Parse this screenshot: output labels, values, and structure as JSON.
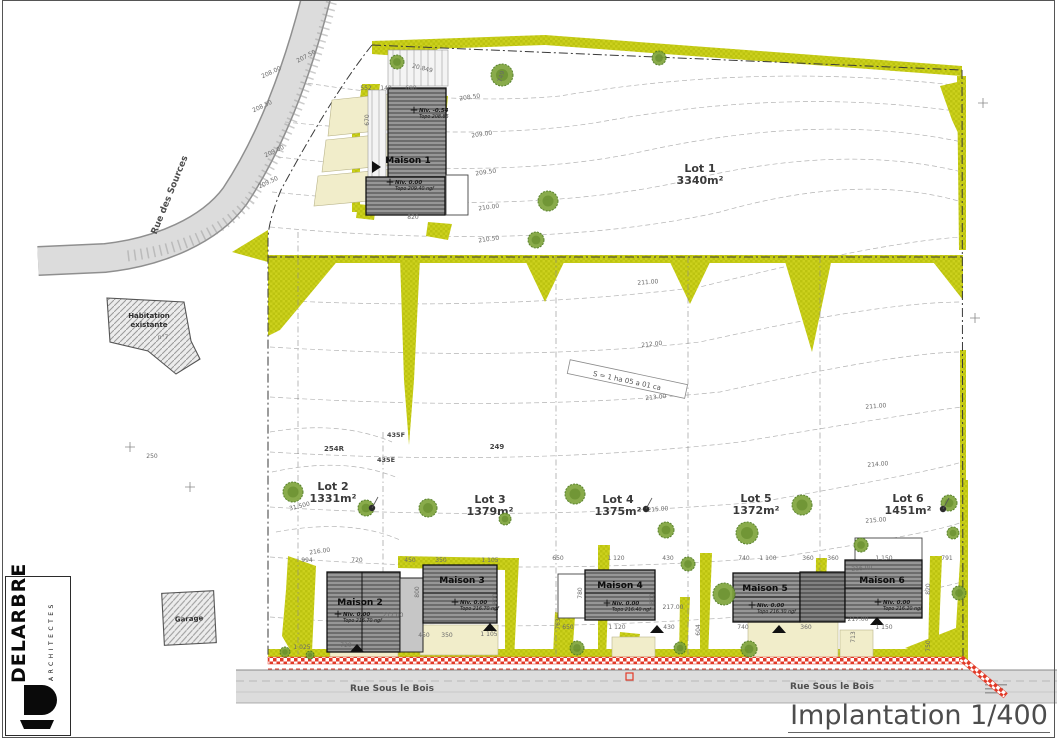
{
  "sheet": {
    "title": "Implantation 1/400"
  },
  "firm": {
    "name": "DELARBRE",
    "subtitle": "ARCHITECTES"
  },
  "streets": {
    "sources": "Rue des Sources",
    "sous_le_bois_1": "Rue Sous le Bois",
    "sous_le_bois_2": "Rue Sous le Bois"
  },
  "site": {
    "total_area": "S = 1 ha 05 a 01 ca"
  },
  "existing": {
    "habitation_1": "Habitation",
    "habitation_2": "existante",
    "habitation_no": "n°7",
    "garage": "Garage"
  },
  "lots": [
    {
      "name": "Lot 1",
      "area": "3340m²"
    },
    {
      "name": "Lot 2",
      "area": "1331m²"
    },
    {
      "name": "Lot 3",
      "area": "1379m²"
    },
    {
      "name": "Lot 4",
      "area": "1375m²"
    },
    {
      "name": "Lot 5",
      "area": "1372m²"
    },
    {
      "name": "Lot 6",
      "area": "1451m²"
    }
  ],
  "houses": [
    {
      "name": "Maison 1",
      "niv": "Niv. 0.00",
      "topo": "Topo 209.40 ngf"
    },
    {
      "name": "Maison 2",
      "niv": "Niv. 0.00",
      "topo": "Topo 216.70 ngf"
    },
    {
      "name": "Maison 3",
      "niv": "Niv. 0.00",
      "topo": "Topo 216.70 ngf"
    },
    {
      "name": "Maison 4",
      "niv": "Niv. 0.00",
      "topo": "Topo 216.40 ngf"
    },
    {
      "name": "Maison 5",
      "niv": "Niv. 0.00",
      "topo": "Topo 216.30 ngf"
    },
    {
      "name": "Maison 6",
      "niv": "Niv. 0.00",
      "topo": "Topo 216.20 ngf"
    }
  ],
  "house1_upper": {
    "niv": "Niv. -0.54",
    "topo": "Topo 208.86"
  },
  "plan": {
    "labels": [
      {
        "t": "207.50",
        "x": 307,
        "y": 58,
        "r": -28
      },
      {
        "t": "208.00",
        "x": 272,
        "y": 74,
        "r": -25
      },
      {
        "t": "208.50",
        "x": 263,
        "y": 108,
        "r": -25
      },
      {
        "t": "209.00",
        "x": 275,
        "y": 153,
        "r": -25
      },
      {
        "t": "209.50",
        "x": 269,
        "y": 184,
        "r": -25
      },
      {
        "t": "208.50",
        "x": 470,
        "y": 99,
        "r": -8
      },
      {
        "t": "209.00",
        "x": 482,
        "y": 136,
        "r": -8
      },
      {
        "t": "209.50",
        "x": 486,
        "y": 174,
        "r": -8
      },
      {
        "t": "210.00",
        "x": 489,
        "y": 209,
        "r": -8
      },
      {
        "t": "210.50",
        "x": 489,
        "y": 241,
        "r": -8
      },
      {
        "t": "211.00",
        "x": 648,
        "y": 284,
        "r": -4
      },
      {
        "t": "212.00",
        "x": 652,
        "y": 346,
        "r": -6
      },
      {
        "t": "213.00",
        "x": 656,
        "y": 399,
        "r": -6
      },
      {
        "t": "211.00",
        "x": 876,
        "y": 408,
        "r": -4
      },
      {
        "t": "214.00",
        "x": 878,
        "y": 466,
        "r": -4
      },
      {
        "t": "215.00",
        "x": 658,
        "y": 511,
        "r": -4
      },
      {
        "t": "215.00",
        "x": 876,
        "y": 522,
        "r": -4
      },
      {
        "t": "216.00",
        "x": 320,
        "y": 553,
        "r": -8
      },
      {
        "t": "216.00",
        "x": 862,
        "y": 570,
        "r": -4
      },
      {
        "t": "217.00",
        "x": 393,
        "y": 617
      },
      {
        "t": "217.00",
        "x": 673,
        "y": 609
      },
      {
        "t": "217.00",
        "x": 858,
        "y": 621
      },
      {
        "t": "31.500",
        "x": 300,
        "y": 508,
        "r": -14
      },
      {
        "t": "20.849",
        "x": 422,
        "y": 70,
        "r": 14
      },
      {
        "t": "254R",
        "x": 334,
        "y": 451,
        "s": 7,
        "b": 1,
        "c": "#444"
      },
      {
        "t": "435F",
        "x": 396,
        "y": 437,
        "s": 6.5,
        "b": 1,
        "c": "#444"
      },
      {
        "t": "435E",
        "x": 386,
        "y": 462,
        "s": 6.5,
        "b": 1,
        "c": "#444"
      },
      {
        "t": "249",
        "x": 497,
        "y": 449,
        "s": 7,
        "b": 1,
        "c": "#444"
      },
      {
        "t": "250",
        "x": 152,
        "y": 458
      },
      {
        "t": "994",
        "x": 307,
        "y": 562
      },
      {
        "t": "720",
        "x": 357,
        "y": 562
      },
      {
        "t": "450",
        "x": 410,
        "y": 562
      },
      {
        "t": "350",
        "x": 441,
        "y": 562
      },
      {
        "t": "1 105",
        "x": 490,
        "y": 562
      },
      {
        "t": "650",
        "x": 558,
        "y": 560
      },
      {
        "t": "1 120",
        "x": 616,
        "y": 560
      },
      {
        "t": "430",
        "x": 668,
        "y": 560
      },
      {
        "t": "740",
        "x": 744,
        "y": 560
      },
      {
        "t": "1 100",
        "x": 768,
        "y": 560
      },
      {
        "t": "360",
        "x": 808,
        "y": 560
      },
      {
        "t": "360",
        "x": 833,
        "y": 560
      },
      {
        "t": "1 150",
        "x": 884,
        "y": 560
      },
      {
        "t": "791",
        "x": 947,
        "y": 560
      },
      {
        "t": "1 025",
        "x": 302,
        "y": 649
      },
      {
        "t": "720",
        "x": 346,
        "y": 647
      },
      {
        "t": "450",
        "x": 424,
        "y": 637
      },
      {
        "t": "350",
        "x": 447,
        "y": 637
      },
      {
        "t": "1 105",
        "x": 489,
        "y": 636
      },
      {
        "t": "650",
        "x": 568,
        "y": 629
      },
      {
        "t": "1 120",
        "x": 617,
        "y": 629
      },
      {
        "t": "430",
        "x": 669,
        "y": 629
      },
      {
        "t": "740",
        "x": 743,
        "y": 629
      },
      {
        "t": "360",
        "x": 806,
        "y": 629
      },
      {
        "t": "1 150",
        "x": 884,
        "y": 629
      },
      {
        "t": "713",
        "x": 855,
        "y": 637,
        "r": -90
      },
      {
        "t": "763",
        "x": 560,
        "y": 624,
        "r": -90
      },
      {
        "t": "604",
        "x": 700,
        "y": 630,
        "r": -90
      },
      {
        "t": "670",
        "x": 369,
        "y": 120,
        "r": -90
      },
      {
        "t": "800",
        "x": 419,
        "y": 592,
        "r": -90
      },
      {
        "t": "800",
        "x": 497,
        "y": 599,
        "r": -90
      },
      {
        "t": "780",
        "x": 582,
        "y": 593,
        "r": -90
      },
      {
        "t": "800",
        "x": 654,
        "y": 599,
        "r": -90
      },
      {
        "t": "820",
        "x": 930,
        "y": 589,
        "r": -90
      },
      {
        "t": "750",
        "x": 930,
        "y": 646,
        "r": -90
      },
      {
        "t": "552",
        "x": 366,
        "y": 90
      },
      {
        "t": "140",
        "x": 386,
        "y": 90
      },
      {
        "t": "690",
        "x": 411,
        "y": 90
      },
      {
        "t": "749",
        "x": 503,
        "y": 77,
        "r": -75
      },
      {
        "t": "820",
        "x": 413,
        "y": 219
      }
    ],
    "trees": [
      [
        397,
        62,
        7
      ],
      [
        502,
        75,
        11
      ],
      [
        659,
        58,
        7
      ],
      [
        548,
        201,
        10
      ],
      [
        536,
        240,
        8
      ],
      [
        293,
        492,
        10
      ],
      [
        366,
        508,
        8
      ],
      [
        428,
        508,
        9
      ],
      [
        505,
        519,
        6
      ],
      [
        575,
        494,
        10
      ],
      [
        666,
        530,
        8
      ],
      [
        724,
        594,
        11
      ],
      [
        688,
        564,
        7
      ],
      [
        802,
        505,
        10
      ],
      [
        747,
        533,
        11
      ],
      [
        949,
        503,
        8
      ],
      [
        953,
        533,
        6
      ],
      [
        861,
        545,
        7
      ],
      [
        577,
        648,
        7
      ],
      [
        749,
        649,
        8
      ],
      [
        959,
        593,
        7
      ],
      [
        680,
        648,
        6
      ],
      [
        285,
        652,
        5
      ],
      [
        310,
        655,
        4
      ]
    ],
    "crosses": [
      [
        190,
        487
      ],
      [
        130,
        447
      ],
      [
        975,
        318
      ],
      [
        983,
        103
      ]
    ],
    "poles": [
      [
        372,
        508
      ],
      [
        646,
        509
      ],
      [
        943,
        509
      ]
    ]
  },
  "colors": {
    "hedge": "#ccd11d",
    "tree_fill": "#7fa43c",
    "tree_stroke": "#4e7a1f",
    "road": "#dcdcdc",
    "roof": "#969696",
    "red": "#e23a28",
    "beige": "#f1edca"
  }
}
